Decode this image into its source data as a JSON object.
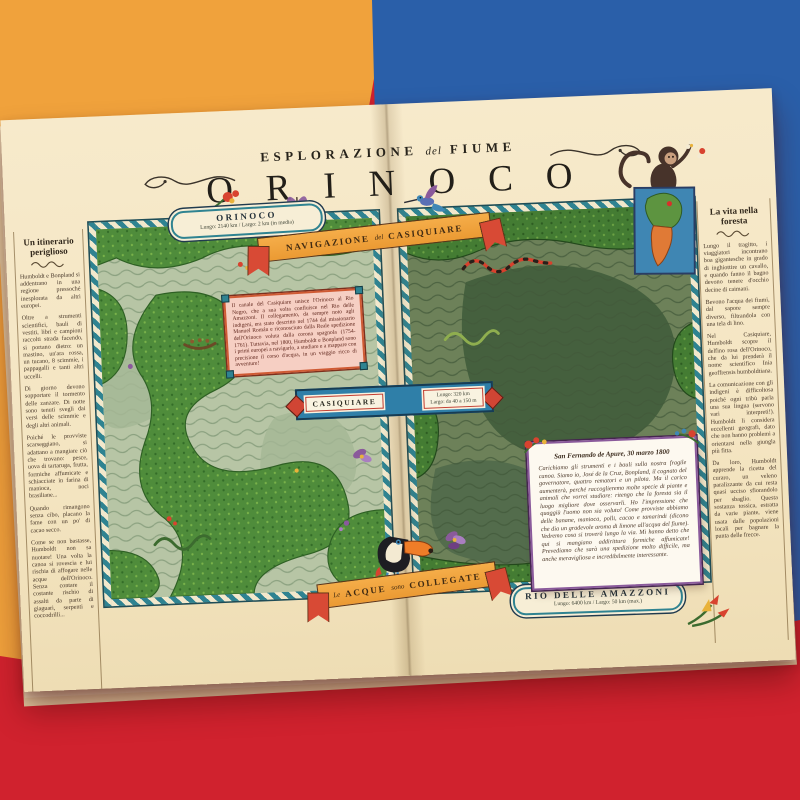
{
  "photo": {
    "background_colors": {
      "orange": "#f0a23c",
      "blue": "#2a5fa9",
      "red": "#d0222e",
      "paper": "#f4e5c2"
    }
  },
  "poster": {
    "header": {
      "kicker_left": "ESPLORAZIONE",
      "kicker_mid": "del",
      "kicker_right": "FIUME",
      "title": "ORINOCO"
    },
    "orinoco_badge": {
      "name": "ORINOCO",
      "stats": "Lungo: 2140 km / Largo: 2 km (in media)"
    },
    "nav_ribbon": {
      "word1": "NAVIGAZIONE",
      "word2": "del",
      "word3": "CASIQUIARE"
    },
    "casiquiare_note": {
      "text": "Il canale del Casiquiare unisce l'Orinoco al Rio Negro, che a sua volta confluisce nel Rio delle Amazzoni. Il collegamento, da sempre noto agli indigeni, era stato descritto nel 1744 dal missionario Manuel Román e riconosciuto dalla Reale spedizione dell'Orinoco voluta dalla corona spagnola (1754-1761). Tuttavia, nel 1800, Humboldt e Bonpland sono i primi europei a navigarlo, a studiare e a mappare con precisione il corso d'acqua, in un viaggio ricco di avventure!"
    },
    "casiquiare_banner": {
      "name": "CASIQUIARE",
      "stat1": "Lungo: 320 km",
      "stat2": "Largo: da 40 a 150 m"
    },
    "left_column": {
      "title": "Un itinerario periglioso",
      "paragraphs": [
        "Humboldt e Bonpland si addentrano in una regione pressoché inesplorata da altri europei.",
        "Oltre a strumenti scientifici, bauli di vestiti, libri e campioni raccolti strada facendo, si portano dietro: un mastino, un'ara rossa, un tucano, 8 scimmie, i pappagalli e tanti altri uccelli.",
        "Di giorno devono sopportare il tormento delle zanzare. Di notte sono tenuti svegli dai versi delle scimmie e degli altri animali.",
        "Poiché le provviste scarseggiano, si adattano a mangiare ciò che trovano: pesce, uova di tartaruga, frutta, formiche affumicate e schiacciate in farina di manioca, noci brasiliane...",
        "Quando rimangono senza cibo, placano la fame con un po' di cacao secco.",
        "Come se non bastasse, Humboldt non sa nuotare! Una volta la canoa si rovescia e lui rischia di affogare nelle acque dell'Orinoco. Senza contare il costante rischio di assalti da parte di giaguari, serpenti e coccodrilli..."
      ]
    },
    "right_column": {
      "title": "La vita nella foresta",
      "paragraphs": [
        "Lungo il tragitto, i viaggiatori incontrano boa gigantesche in grado di inghiottire un cavallo, e quando fanno il bagno devono tenere d'occhio decine di caimani.",
        "Bevono l'acqua dei fiumi, dal sapore sempre diverso, filtrandola con una tela di lino.",
        "Nel Casiquiare, Humboldt scopre il delfino rosa dell'Orinoco, che da lui prenderà il nome scientifico Inia geoffrensis humboldtiana.",
        "La comunicazione con gli indigeni è difficoltosa poiché ogni tribù parla una sua lingua (servono vari interpreti!). Humboldt li considera eccellenti geografi, dato che non hanno problemi a orientarsi nella giungla più fitta.",
        "Da loro, Humboldt apprende la ricetta del curaro, un veleno paralizzante da cui resta quasi ucciso sfiorandolo per sbaglio. Questa sostanza tossica, estratta da varie piante, viene usata dalle popolazioni locali per bagnare la punta delle frecce."
      ]
    },
    "letter": {
      "dateline": "San Fernando de Apure, 30 marzo 1800",
      "body": "Carichiamo gli strumenti e i bauli sulla nostra fragile canoa. Siamo io, José de la Cruz, Bonpland, il cognato del governatore, quattro rematori e un pilota. Ma il carico aumenterà, perché raccoglieremo molte specie di piante e animali che vorrei studiare: ritengo che la foresta sia il luogo migliore dove osservarli. Ho l'impressione che quaggiù l'uomo non sia voluto! Come provviste abbiamo delle banane, manioca, polli, cacao e tamarindi (dicono che dia un gradevole aroma di limone all'acqua del fiume). Vedremo cosa si troverà lungo la via. Mi hanno detto che qui si mangiano addirittura formiche affumicate! Prevediamo che sarà una spedizione molto difficile, ma anche meravigliosa e incredibilmente interessante."
    },
    "waters_ribbon": {
      "word1": "Le",
      "word2": "ACQUE",
      "word3": "sono",
      "word4": "COLLEGATE"
    },
    "amazon_badge": {
      "name": "RIO DELLE AMAZZONI",
      "stats": "Lungo: 6400 km / Largo: 50 km (max.)"
    },
    "illustrations": {
      "monkey": "spider-monkey-holding-flower",
      "hummingbird": "hummingbird",
      "toucan": "toucan",
      "inset_map": "south-america-inset-map",
      "snakes": "coral-snake-and-anaconda",
      "flowers": "orchids-heliconia-red-flowers",
      "canoe": "expedition-canoe"
    }
  }
}
